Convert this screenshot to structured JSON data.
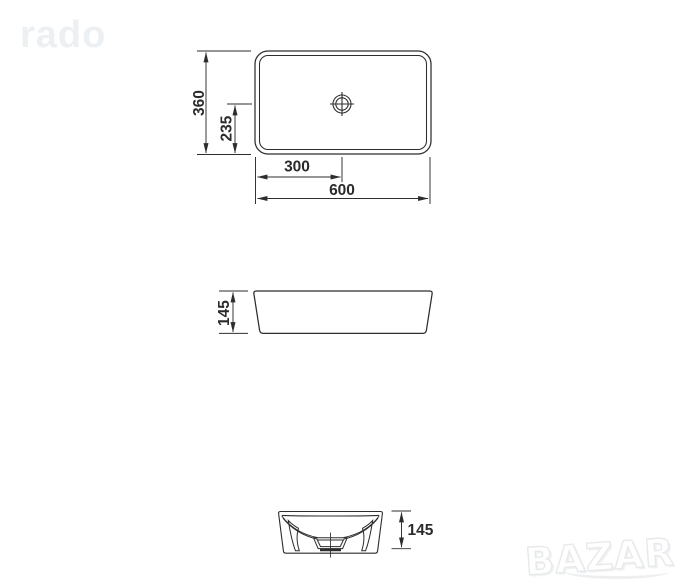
{
  "background": "#ffffff",
  "watermark": {
    "text": "rado",
    "color": "#edf0f3"
  },
  "logo": {
    "text": "BAZAR",
    "fill": "#ffffff",
    "outline": "#e7e9eb"
  },
  "drawing": {
    "subject": "rectangular countertop washbasin technical drawing, three orthographic views",
    "line_color": "#2d2d2d",
    "dims": {
      "top_width": "600",
      "top_height": "360",
      "drain_from_left": "300",
      "drain_from_bottom": "235",
      "side_height": "145",
      "front_height": "145"
    }
  }
}
